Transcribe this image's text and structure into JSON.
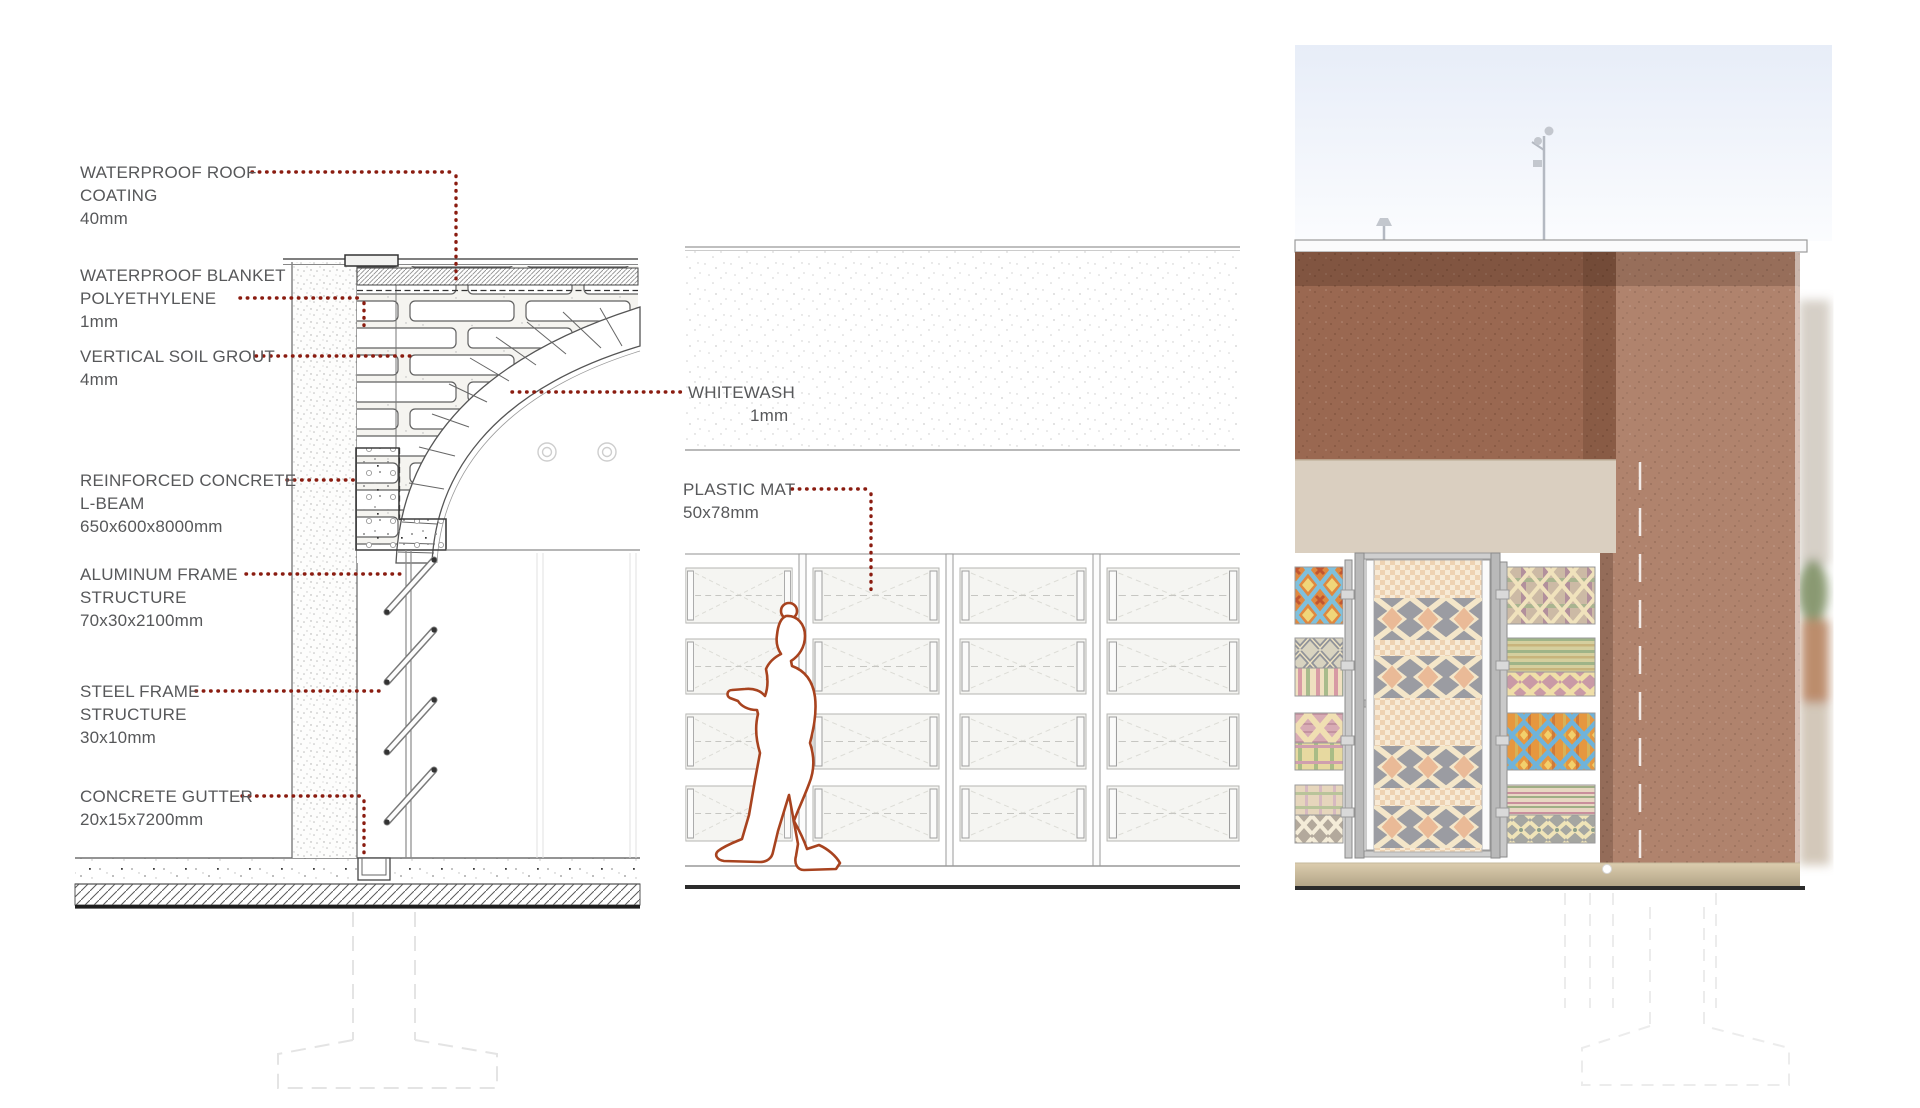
{
  "document": {
    "type": "architectural-detail-board",
    "panels": [
      "wall-section-detail",
      "interior-elevation",
      "facade-render"
    ]
  },
  "annotations": {
    "section": [
      {
        "lines": [
          "WATERPROOF ROOF",
          "COATING",
          "40mm"
        ]
      },
      {
        "lines": [
          "WATERPROOF BLANKET",
          "POLYETHYLENE",
          "1mm"
        ]
      },
      {
        "lines": [
          "VERTICAL SOIL GROUT",
          "4mm"
        ]
      },
      {
        "lines": [
          "REINFORCED CONCRETE",
          "L-BEAM",
          "650x600x8000mm"
        ]
      },
      {
        "lines": [
          "ALUMINUM FRAME",
          "STRUCTURE",
          "70x30x2100mm"
        ]
      },
      {
        "lines": [
          "STEEL FRAME",
          "STRUCTURE",
          "30x10mm"
        ]
      },
      {
        "lines": [
          "CONCRETE GUTTER",
          "20x15x7200mm"
        ]
      }
    ],
    "elevation": [
      {
        "lines": [
          "WHITEWASH",
          "1mm"
        ]
      },
      {
        "lines": [
          "PLASTIC MAT",
          "50x78mm"
        ]
      }
    ]
  },
  "colors": {
    "label_text": "#57585a",
    "leader_dots": "#8a1c10",
    "figure_outline": "#a8431f",
    "wall_brown": "#9a6851",
    "tower_brown": "#a7755d",
    "beige_band": "#dacfc0",
    "base_strip": "#cdbb9c",
    "sky": "#e7edf8",
    "ground_line": "#2b2b2b",
    "textile_orange": "#e0883f",
    "textile_blue": "#7fc0dc",
    "textile_yellow": "#f0d67a",
    "textile_gray": "#9b9ca2"
  }
}
